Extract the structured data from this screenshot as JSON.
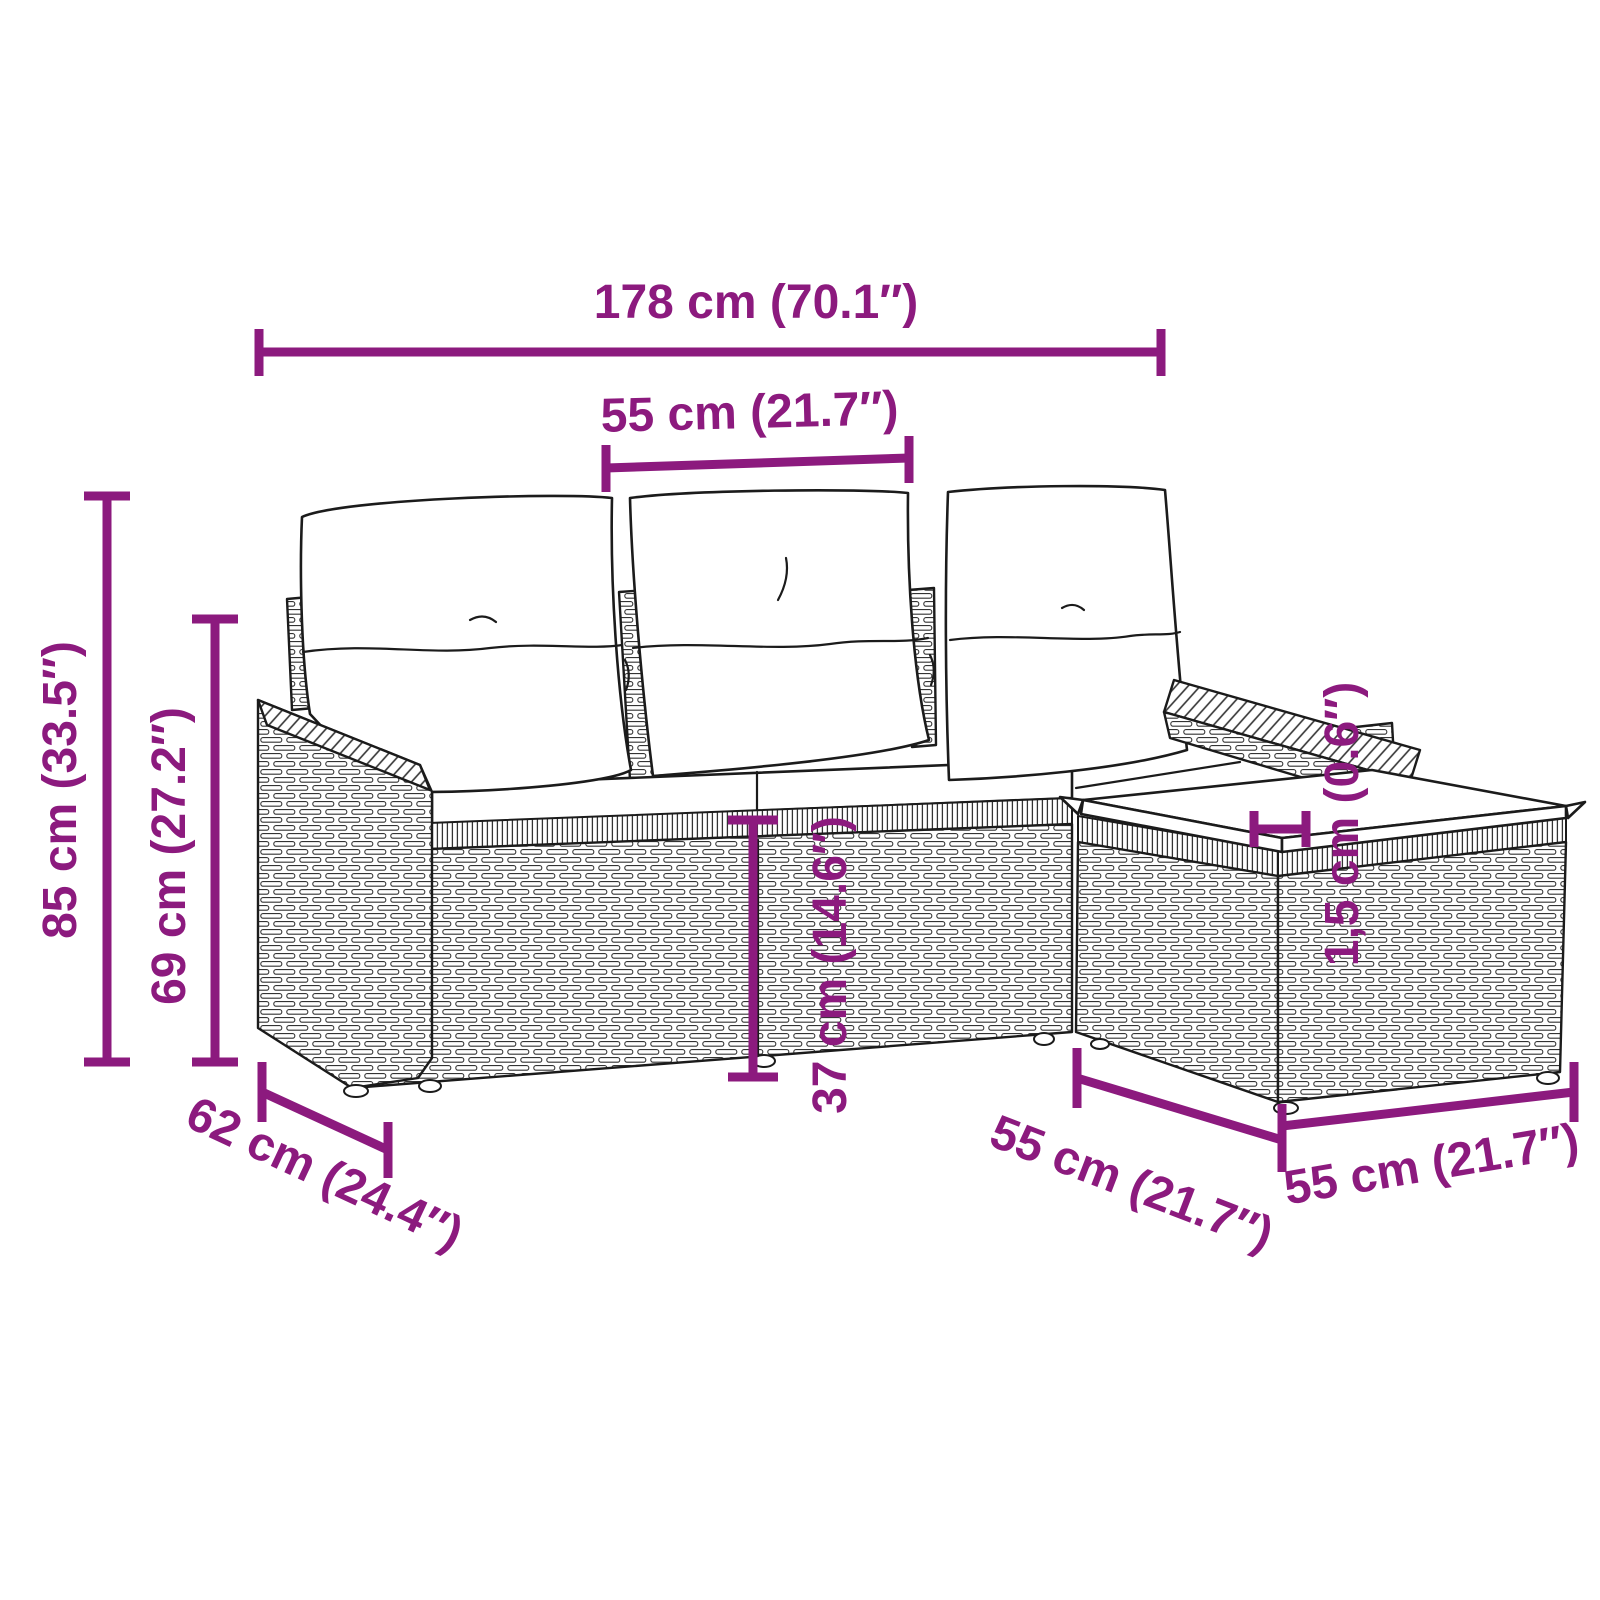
{
  "illustration": {
    "alt": "Line drawing of a 4-piece poly rattan garden sofa set: three-seat sofa with back cushions and seat cushions plus a square footstool with a thin cushion"
  },
  "colors": {
    "dimension_accent": "#8C1A7E",
    "line_art": "#1b1b1b",
    "background": "#ffffff"
  },
  "dims": {
    "total_width": "178 cm (70.1″)",
    "seat_width": "55 cm (21.7″)",
    "total_height": "85 cm (33.5″)",
    "back_height": "69 cm (27.2″)",
    "depth": "62 cm (24.4″)",
    "seat_height": "37 cm (14.6″)",
    "cushion_thickness": "1,5 cm (0.6″)",
    "stool_depth": "55 cm (21.7″)",
    "stool_width": "55 cm (21.7″)"
  }
}
